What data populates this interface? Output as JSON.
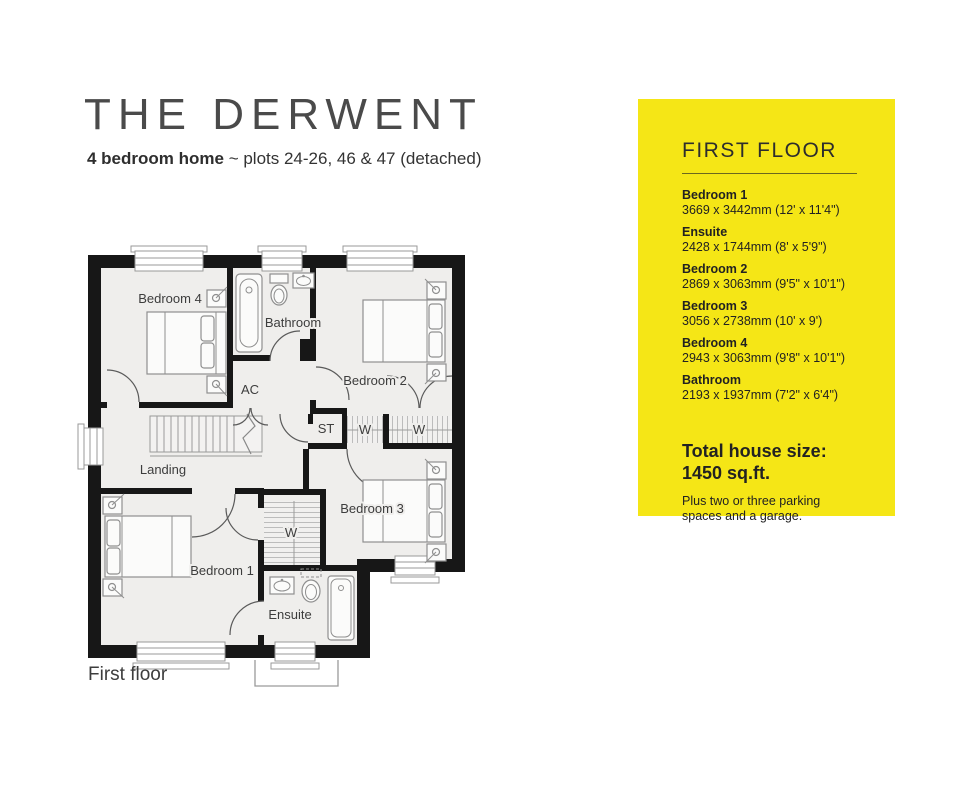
{
  "header": {
    "title": "THE DERWENT",
    "subtitle_bold": "4 bedroom home",
    "subtitle_rest": " ~ plots 24-26, 46 & 47 (detached)"
  },
  "plan": {
    "caption": "First floor",
    "labels": {
      "bedroom4": "Bedroom 4",
      "bathroom": "Bathroom",
      "bedroom2": "Bedroom 2",
      "ac": "AC",
      "landing": "Landing",
      "st": "ST",
      "w1": "W",
      "w2": "W",
      "w3": "W",
      "bedroom3": "Bedroom 3",
      "bedroom1": "Bedroom 1",
      "ensuite": "Ensuite"
    }
  },
  "panel": {
    "heading": "FIRST FLOOR",
    "rooms": [
      {
        "name": "Bedroom 1",
        "dims": "3669 x 3442mm (12' x 11'4\")"
      },
      {
        "name": "Ensuite",
        "dims": "2428 x 1744mm (8' x 5'9\")"
      },
      {
        "name": "Bedroom 2",
        "dims": "2869 x 3063mm (9'5\" x 10'1\")"
      },
      {
        "name": "Bedroom 3",
        "dims": "3056 x 2738mm (10' x 9')"
      },
      {
        "name": "Bedroom 4",
        "dims": "2943 x 3063mm (9'8\" x 10'1\")"
      },
      {
        "name": "Bathroom",
        "dims": "2193 x 1937mm (7'2\" x 6'4\")"
      }
    ],
    "total_title": "Total house size:",
    "total_size": "1450 sq.ft.",
    "note": "Plus two or three parking spaces and a garage."
  },
  "colors": {
    "accent_yellow": "#F5E616",
    "wall": "#171717"
  }
}
